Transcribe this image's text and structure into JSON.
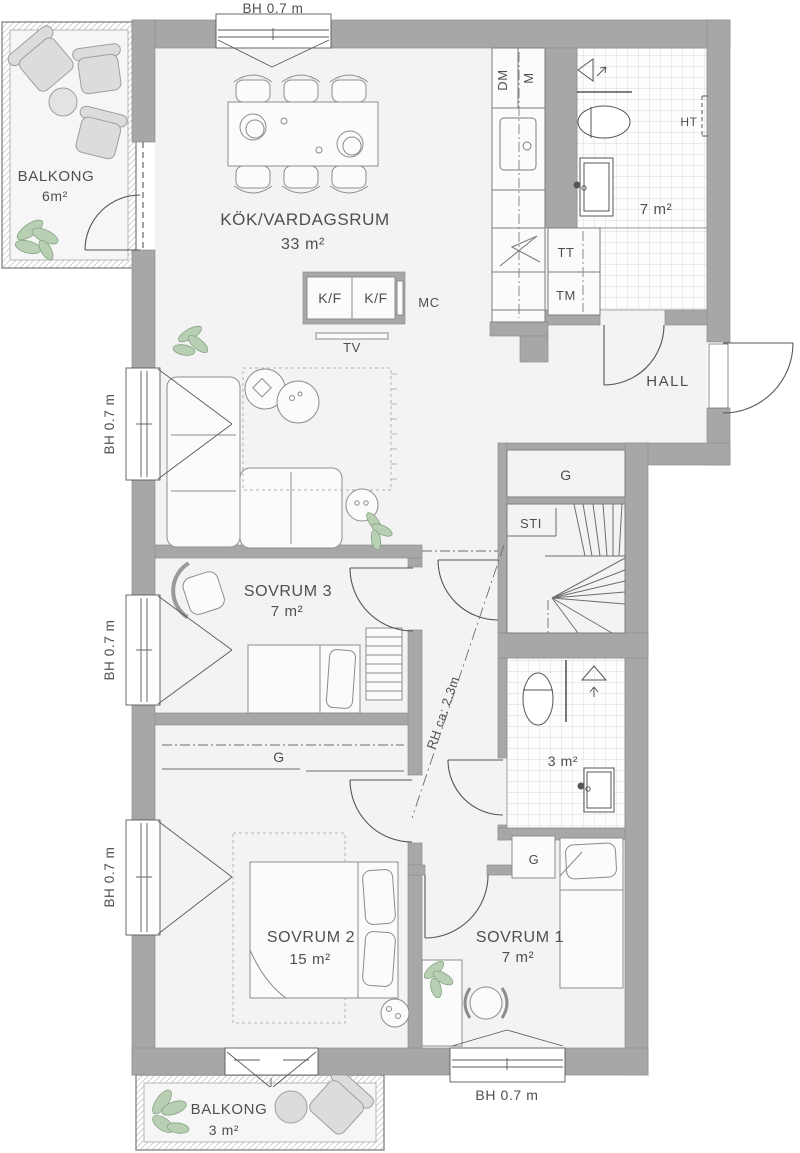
{
  "plan_title": "apartment-floor-plan",
  "colors": {
    "wall": "#a7a7a7",
    "floor": "#f3f3f3",
    "tile_line": "#cdcdcd",
    "outline": "#6a6a6a",
    "text": "#4f4f4f",
    "plant_green": "#b9cfb4",
    "balcony_furniture": "#dcdcdc"
  },
  "rooms": {
    "kitchen_living": {
      "name": "KÖK/VARDAGSRUM",
      "area": "33 m²"
    },
    "bedroom1": {
      "name": "SOVRUM 1",
      "area": "7 m²"
    },
    "bedroom2": {
      "name": "SOVRUM 2",
      "area": "15 m²"
    },
    "bedroom3": {
      "name": "SOVRUM 3",
      "area": "7 m²"
    },
    "hall": {
      "name": "HALL"
    },
    "bathroom_large": {
      "area": "7 m²"
    },
    "bathroom_small": {
      "area": "3 m²"
    },
    "balcony_top": {
      "name": "BALKONG",
      "area": "6m²"
    },
    "balcony_bottom": {
      "name": "BALKONG",
      "area": "3 m²"
    }
  },
  "fixtures": {
    "dishwasher": "DM",
    "micro": "M",
    "fridge_freezer": "K/F",
    "micro_cabinet": "MC",
    "tv": "TV",
    "tumble_dryer": "TT",
    "washing_machine": "TM",
    "towel_dryer": "HT",
    "wardrobe": "G",
    "stairs": "STI"
  },
  "annotations": {
    "window_height": "BH 0.7 m",
    "ceiling_height": "RH ca: 2.3m"
  }
}
